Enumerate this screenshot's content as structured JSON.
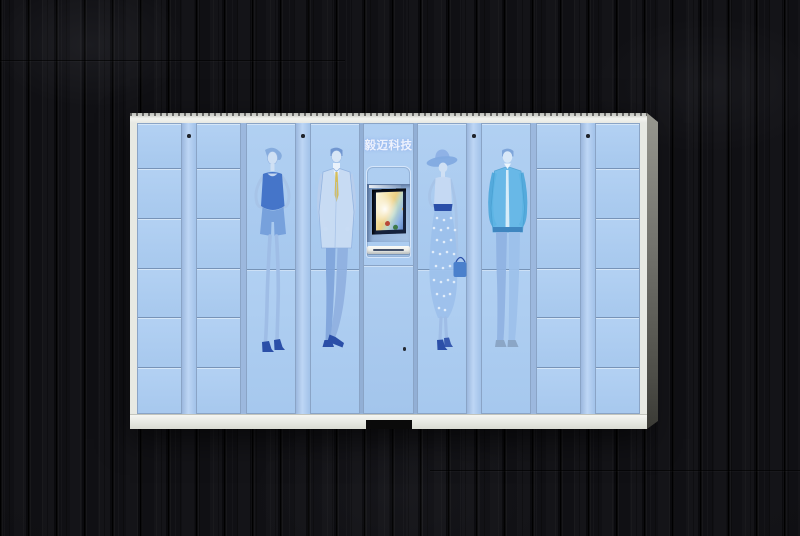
{
  "image": {
    "type": "product-photo",
    "subject": "Smart clothing/parcel locker cabinet with fashion-sketch artwork, standing against a dark wood plank wall",
    "background_color": "#101013"
  },
  "cabinet": {
    "brand_label": "毅迈科技",
    "body_color": "#aac9ee",
    "frame_color": "#edeeea",
    "line_color": "#8aa4c6",
    "side_panel_color": "#7b7b76",
    "base_notch_color": "#0a0a0a",
    "locker_grid": {
      "left_small_columns": 2,
      "right_small_columns": 2,
      "rows_per_small_column": 6,
      "figure_door_columns": 4,
      "doors_per_figure_column": 2
    },
    "layout": [
      {
        "kind": "small-locker-column",
        "rows": 6
      },
      {
        "kind": "divider",
        "screw": true
      },
      {
        "kind": "small-locker-column",
        "rows": 6
      },
      {
        "kind": "gap"
      },
      {
        "kind": "figure-door-column",
        "art": "woman-tank-outfit"
      },
      {
        "kind": "divider",
        "screw": true
      },
      {
        "kind": "figure-door-column",
        "art": "man-suit-tie"
      },
      {
        "kind": "thin-gap"
      },
      {
        "kind": "console-column"
      },
      {
        "kind": "thin-gap"
      },
      {
        "kind": "figure-door-column",
        "art": "woman-sunhat-skirt"
      },
      {
        "kind": "divider",
        "screw": true
      },
      {
        "kind": "figure-door-column",
        "art": "man-casual-jacket"
      },
      {
        "kind": "gap"
      },
      {
        "kind": "small-locker-column",
        "rows": 6
      },
      {
        "kind": "divider",
        "screw": true
      },
      {
        "kind": "small-locker-column",
        "rows": 6
      }
    ],
    "console": {
      "brand_label": "毅迈科技",
      "screen_bezel_color": "#15223d",
      "screen_content_colors": [
        "#fbf5da",
        "#f2dc9a",
        "#b84838",
        "#3f7a48",
        "#5f86c8"
      ],
      "slot_color": "#f4f5f1",
      "keyhole_color": "#242a33"
    },
    "figures": [
      {
        "name": "woman-tank-outfit",
        "description": "fashion sketch: woman in vivid blue tank top and shorts, hands on hips, high heels"
      },
      {
        "name": "man-suit-tie",
        "description": "fashion sketch: man in pale blue suit with yellow tie, ankles crossed"
      },
      {
        "name": "woman-sunhat-skirt",
        "description": "fashion sketch: woman in wide-brim sun hat, long polka-dot skirt, holding a blue handbag"
      },
      {
        "name": "man-casual-jacket",
        "description": "fashion sketch: man in cyan casual jacket and jeans"
      }
    ]
  }
}
